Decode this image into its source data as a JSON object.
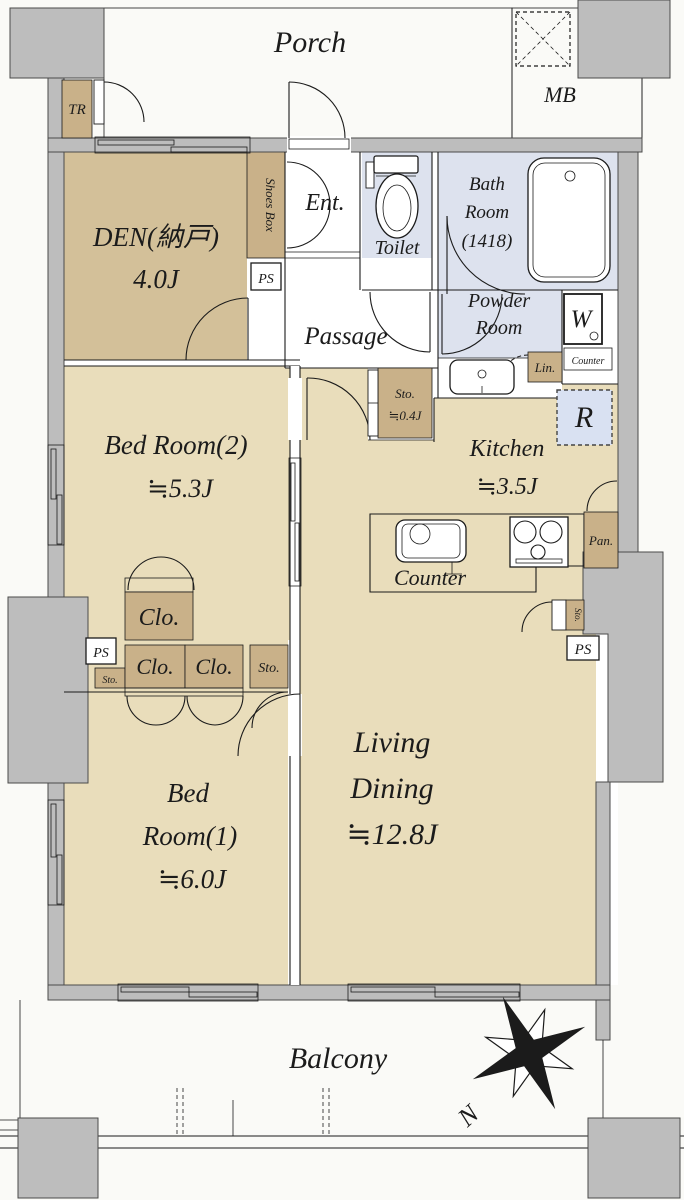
{
  "colors": {
    "room_beige": "#e9ddbb",
    "den_tan": "#d3c099",
    "closet_tan": "#c9b189",
    "wet_blue": "#dde2ee",
    "appliance_blue": "#d9e1f2",
    "wall_gray": "#bdbdbd",
    "wall_edge": "#4a4a4a",
    "line": "#1b1b1b",
    "paper": "#fafaf7"
  },
  "exterior": {
    "porch": "Porch",
    "balcony": "Balcony",
    "meter_box": "MB",
    "trunk": "TR",
    "north": "N"
  },
  "rooms": {
    "den": {
      "name": "DEN(納戸)",
      "size": "4.0J"
    },
    "bedroom2": {
      "name": "Bed Room(2)",
      "size": "≒5.3J"
    },
    "bedroom1": {
      "l1": "Bed",
      "l2": "Room(1)",
      "size": "≒6.0J"
    },
    "living": {
      "l1": "Living",
      "l2": "Dining",
      "size": "≒12.8J"
    },
    "kitchen": {
      "name": "Kitchen",
      "size": "≒3.5J"
    },
    "bath": {
      "l1": "Bath",
      "l2": "Room",
      "l3": "(1418)"
    },
    "powder": {
      "l1": "Powder",
      "l2": "Room"
    },
    "toilet": "Toilet",
    "entrance": "Ent.",
    "passage": "Passage"
  },
  "fixtures": {
    "shoes_box": "Shoes Box",
    "washer": "W",
    "linen": "Lin.",
    "counter_shelf": "Counter",
    "kitchen_counter": "Counter",
    "refrigerator": "R",
    "pantry": "Pan.",
    "closet": "Clo.",
    "storage": "Sto.",
    "storage_04": {
      "l1": "Sto.",
      "l2": "≒0.4J"
    },
    "pipe_space": "PS"
  }
}
